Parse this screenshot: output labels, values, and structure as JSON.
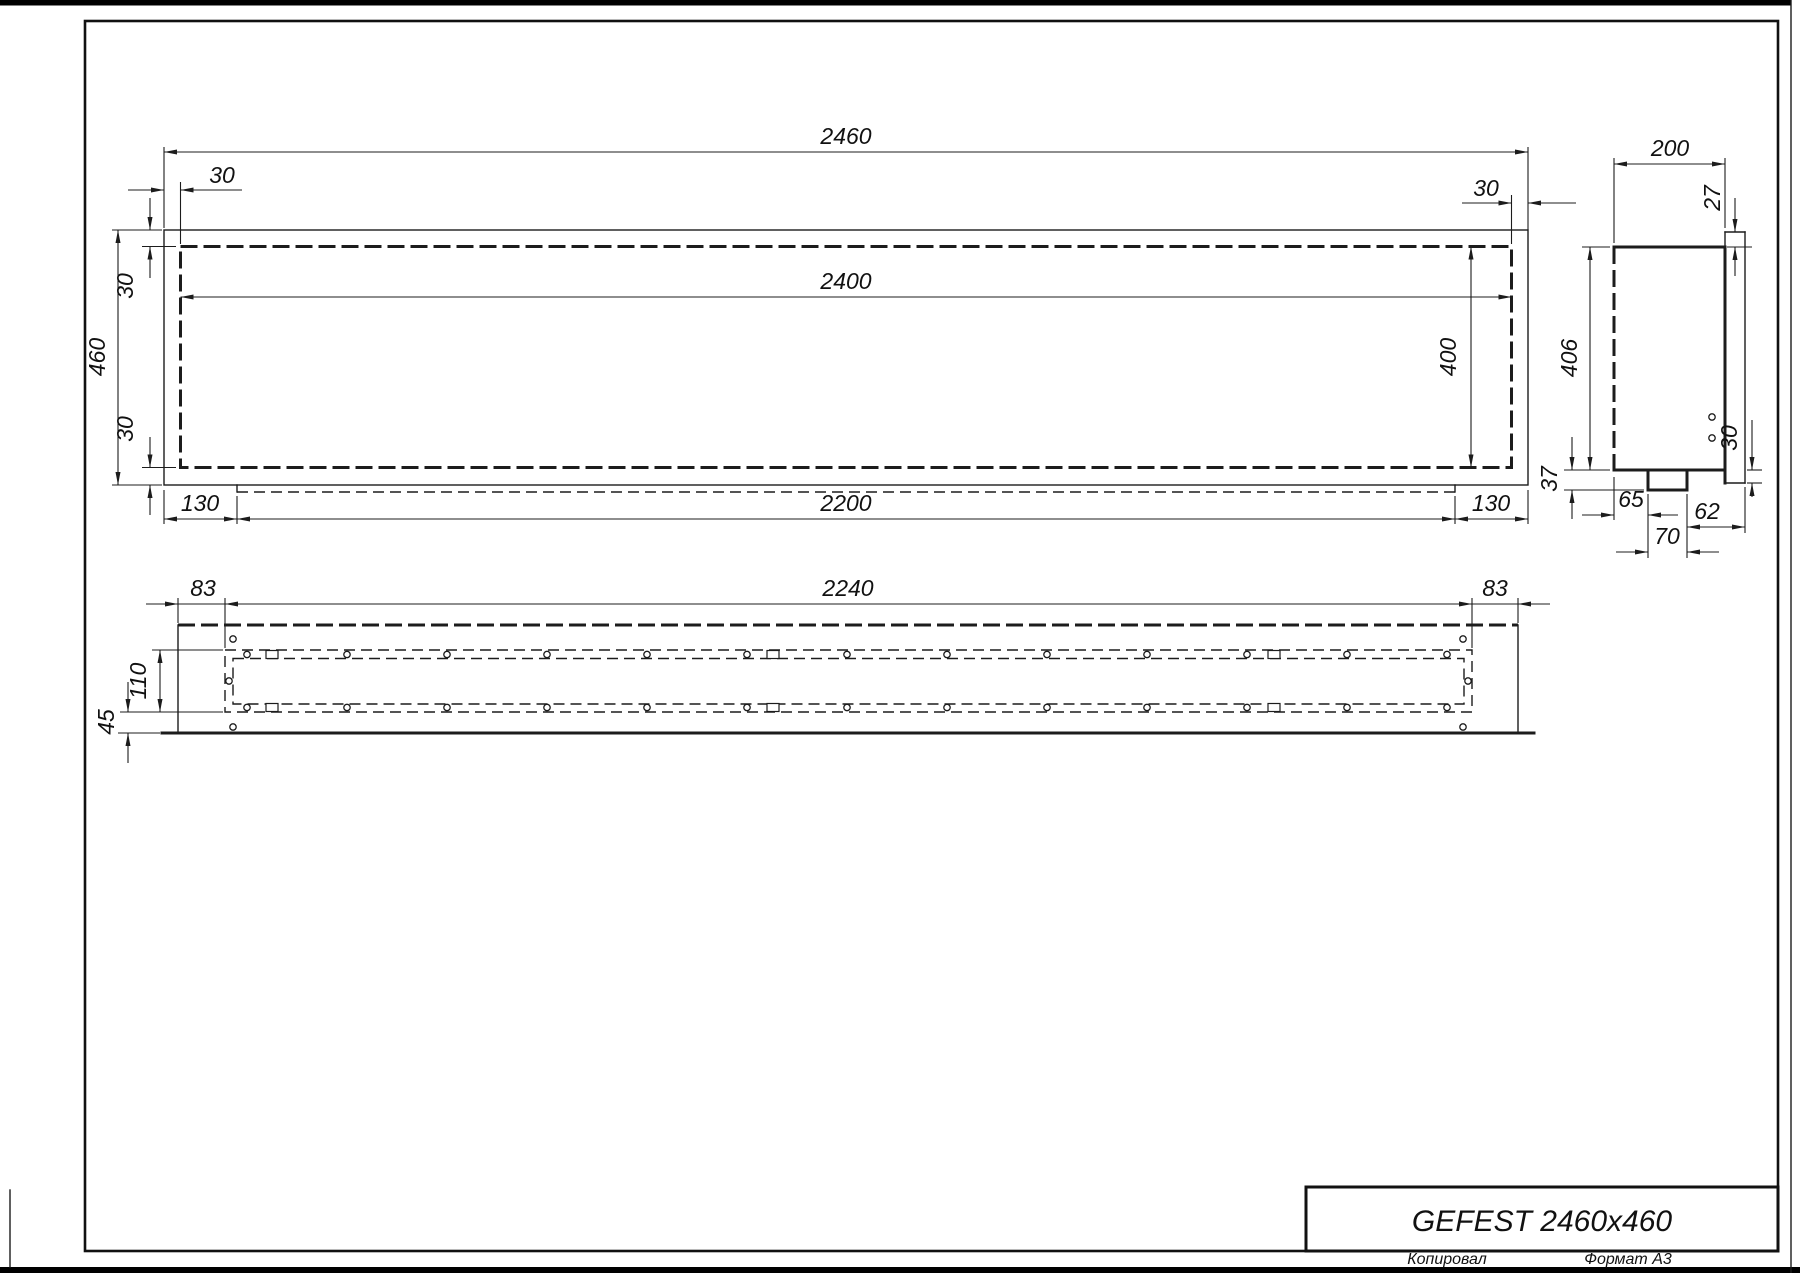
{
  "sheet": {
    "title": "GEFEST 2460x460",
    "footer_left": "Копировал",
    "footer_right": "Формат А3"
  },
  "front": {
    "overall_width": "2460",
    "opening_width": "2400",
    "overall_height": "460",
    "opening_height": "400",
    "offset_top_left": "30",
    "offset_top_right": "30",
    "offset_side_top": "30",
    "offset_side_bottom": "30",
    "base_inset_left": "130",
    "base_width": "2200",
    "base_inset_right": "130"
  },
  "side": {
    "depth": "200",
    "top_lip": "27",
    "height": "406",
    "bottom_lip": "30",
    "bracket_drop": "37",
    "bracket_offset_left": "65",
    "bracket_width": "70",
    "bracket_offset_right": "62"
  },
  "bottom": {
    "inset_left": "83",
    "opening_width": "2240",
    "inset_right": "83",
    "tray_depth": "110",
    "front_offset": "45"
  }
}
